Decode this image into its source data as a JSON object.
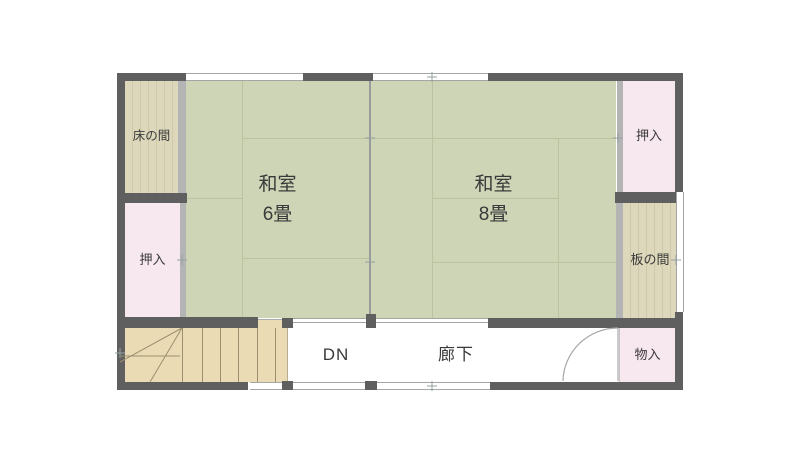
{
  "plan": {
    "rooms": {
      "tokonoma": {
        "label": "床の間"
      },
      "oshiire_left": {
        "label": "押入"
      },
      "washitsu6": {
        "name": "和室",
        "size": "6畳"
      },
      "washitsu8": {
        "name": "和室",
        "size": "8畳"
      },
      "oshiire_right": {
        "label": "押入"
      },
      "itanoma": {
        "label": "板の間"
      },
      "monoire": {
        "label": "物入"
      },
      "corridor": {
        "label": "廊下"
      },
      "stairs": {
        "label": "DN"
      }
    },
    "colors": {
      "tatami": "#cdd5b6",
      "tatami_line": "#b9c49e",
      "wood": "#ddd8bb",
      "wood_grain": "#cfc9a9",
      "closet_pink": "#f7e8ef",
      "stair_tan": "#ebdbb5",
      "wall_dark": "#5f5f5f",
      "wall_light": "#b4b4b4",
      "open_line": "#a5a5a5",
      "stair_line": "#9a8f6f",
      "door_line": "#a8a8a8",
      "tick": "#97a0a0",
      "text": "#3a3a3a",
      "background": "#ffffff"
    }
  }
}
